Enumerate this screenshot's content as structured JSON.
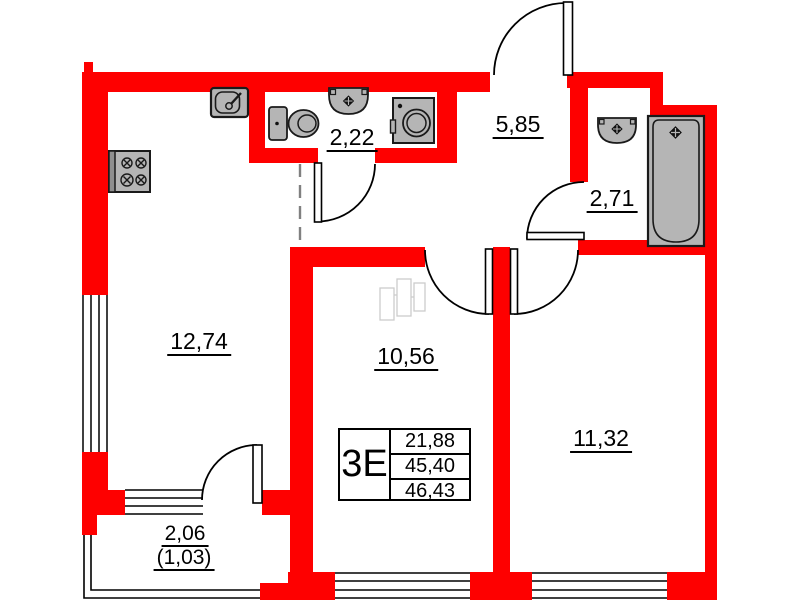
{
  "plan": {
    "description": "apartment-floor-plan",
    "unit_label": "3Е",
    "spec_values": [
      "21,88",
      "45,40",
      "46,43"
    ],
    "rooms": {
      "kitchen_living": {
        "area": "12,74"
      },
      "hallway": {
        "area": "5,85"
      },
      "wc": {
        "area": "2,22"
      },
      "bathroom": {
        "area": "2,71"
      },
      "room_1": {
        "area": "10,56"
      },
      "room_2": {
        "area": "11,32"
      },
      "balcony": {
        "area": "2,06",
        "area_reduced": "(1,03)"
      }
    },
    "icons": {
      "stove": "4-burner-stove",
      "kitchen_sink": "sink-with-faucet",
      "toilet": "toilet-with-tank",
      "wc_basin": "wall-basin",
      "washing_machine": "washing-machine",
      "bath_basin": "wall-basin",
      "bathtub": "bathtub"
    },
    "colors": {
      "wall": "#fe0000",
      "fixture_fill": "#b5b5b5",
      "line": "#000000",
      "sketch": "#cccccc",
      "dashed_opening": "#808080",
      "background": "#ffffff"
    }
  }
}
